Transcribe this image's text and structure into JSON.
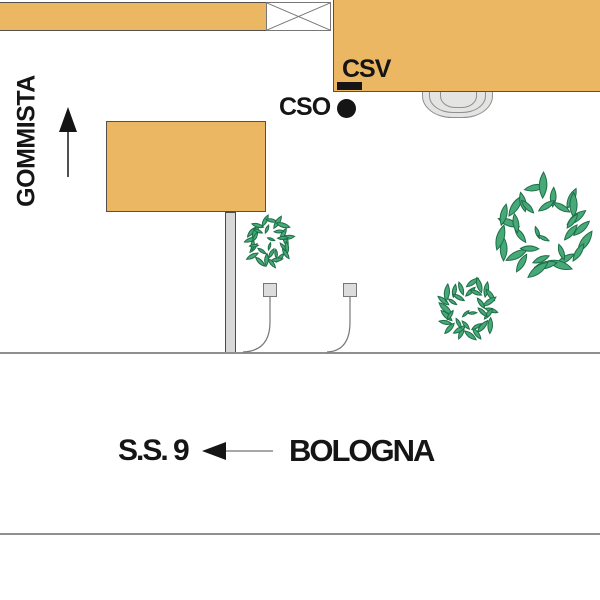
{
  "title": "Location map",
  "colors": {
    "building_fill": "#EBB763",
    "building_border": "#55504A",
    "leaf_fill": "#47A878",
    "leaf_border": "#1E6F48",
    "road_gray": "#8F8F8F",
    "marker_black": "#151515",
    "pole_fill": "#D8D8D8",
    "arch_fill": "#E4E4E2"
  },
  "labels": {
    "street": "GOMMISTA",
    "marker_csv": "CSV",
    "marker_cso": "CSO",
    "road": "S.S. 9",
    "city": "BOLOGNA"
  },
  "map": {
    "bushes": [
      {
        "cx": 269,
        "cy": 242,
        "r": 26,
        "seed": 7
      },
      {
        "cx": 468,
        "cy": 310,
        "r": 33,
        "seed": 13
      },
      {
        "cx": 543,
        "cy": 229,
        "r": 53,
        "seed": 21
      }
    ]
  }
}
